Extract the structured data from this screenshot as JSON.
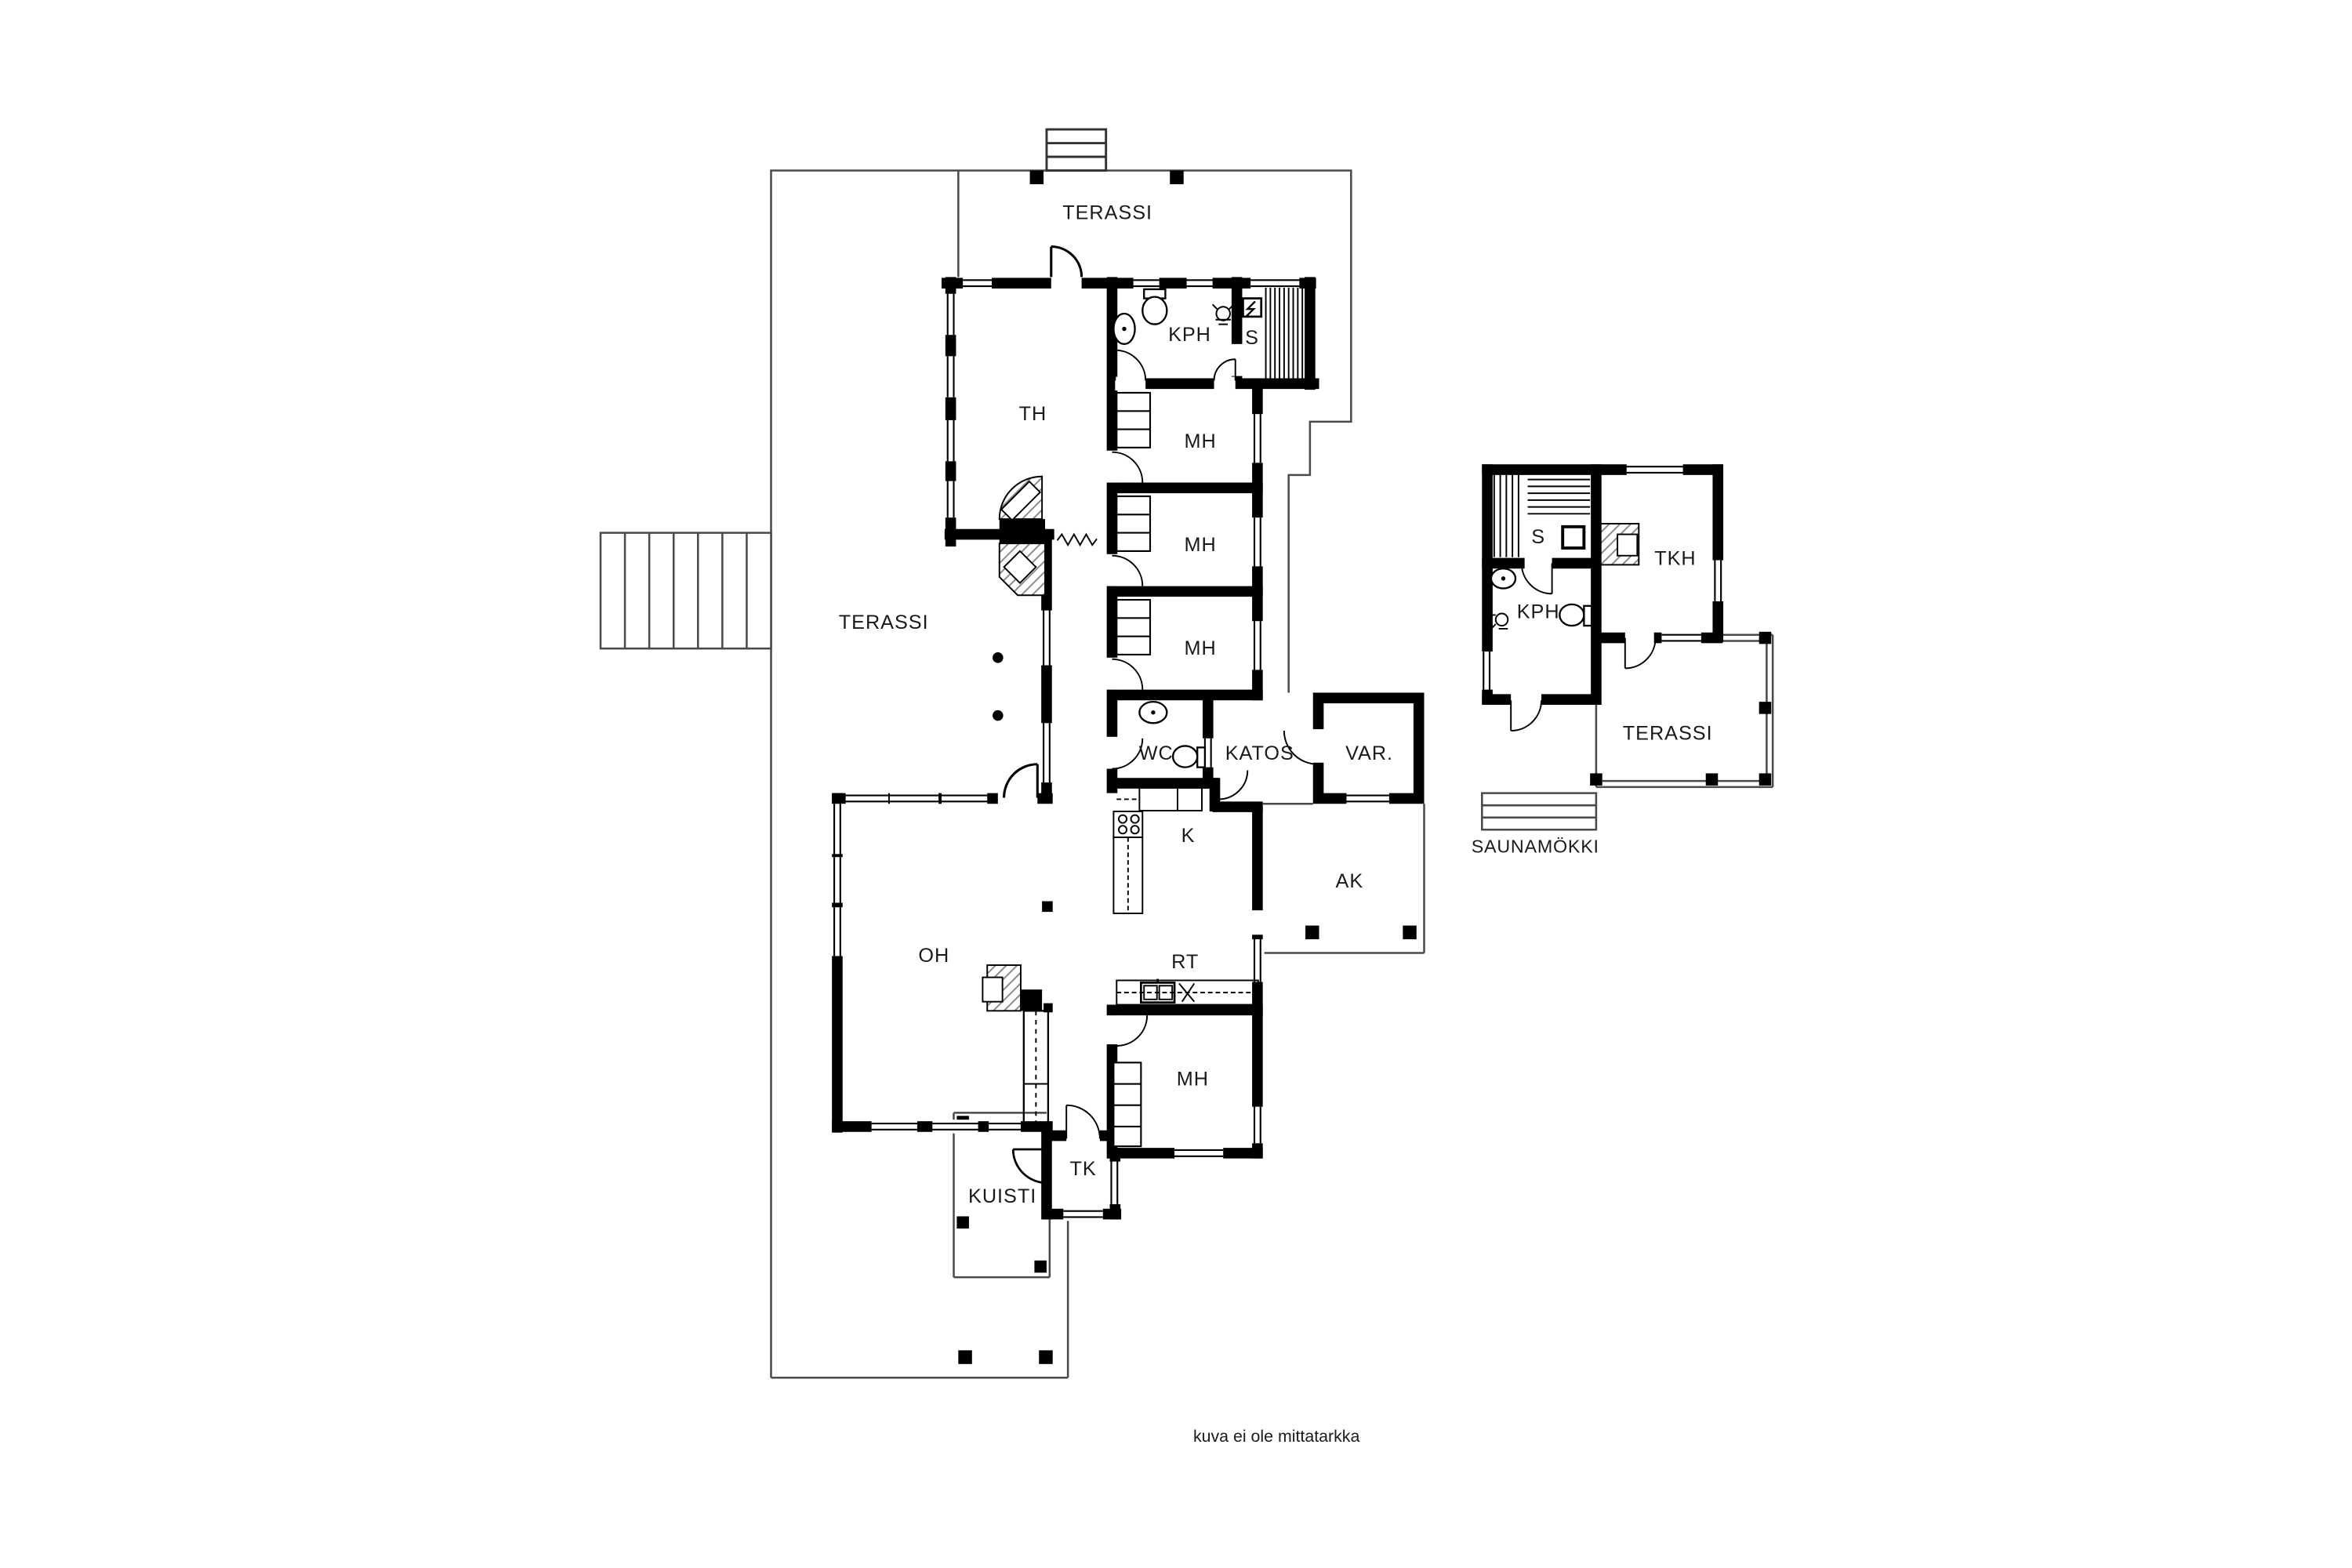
{
  "document": {
    "type": "architectural floor plan",
    "note": "kuva ei ole mittatarkka"
  },
  "main_house": {
    "terraces": {
      "top": "TERASSI",
      "left": "TERASSI"
    },
    "rooms": {
      "th": "TH",
      "kph": "KPH",
      "sauna": "S",
      "bedroom1": "MH",
      "bedroom2": "MH",
      "bedroom3": "MH",
      "wc": "WC",
      "katos": "KATOS",
      "storage": "VAR.",
      "kitchen": "K",
      "ak": "AK",
      "living": "OH",
      "rt": "RT",
      "bedroom4": "MH",
      "entry": "TK",
      "porch": "KUISTI"
    }
  },
  "cottage": {
    "name": "SAUNAMÖKKI",
    "rooms": {
      "sauna": "S",
      "tkh": "TKH",
      "kph": "KPH",
      "terrace": "TERASSI"
    }
  },
  "colors": {
    "walls": "#000000",
    "background": "#ffffff",
    "site_lines": "#4a4a4a",
    "hatch": "#8a8a8a"
  }
}
